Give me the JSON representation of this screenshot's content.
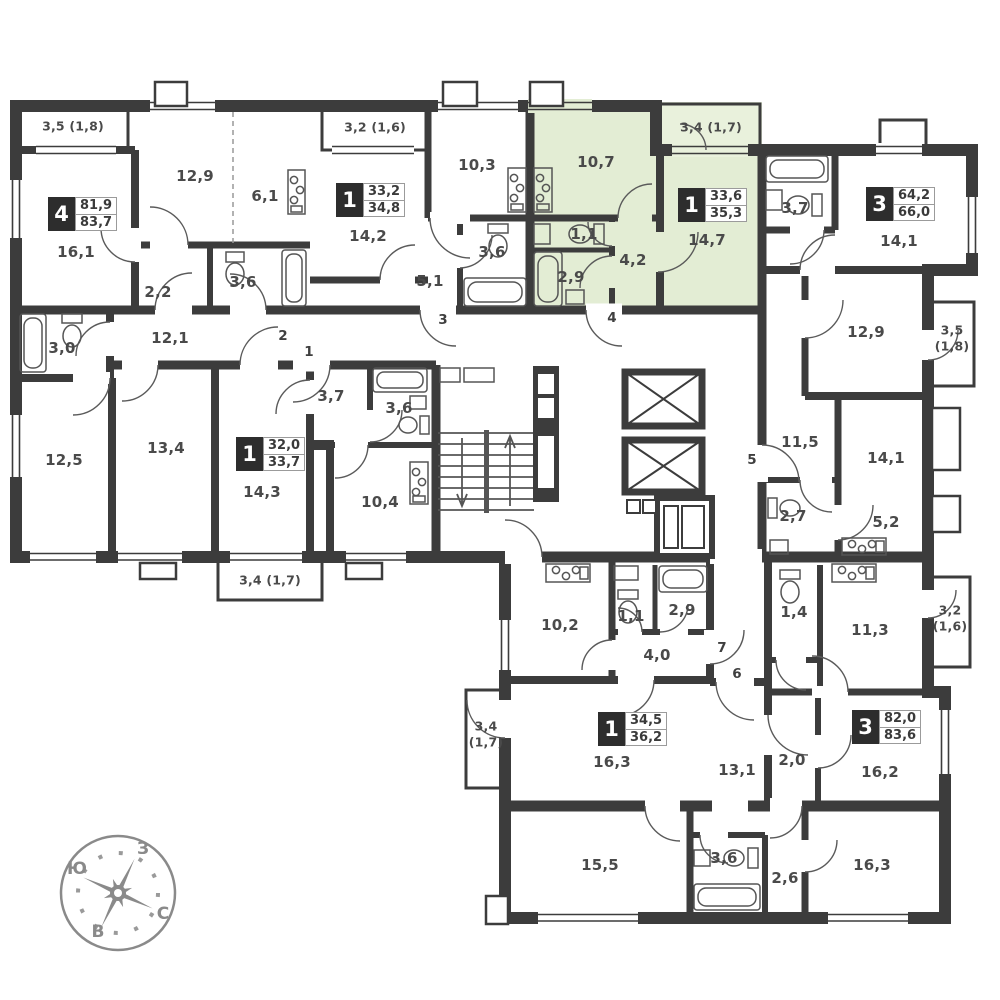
{
  "plan": {
    "colors": {
      "wall": "#3c3c3c",
      "text": "#4a4a4a",
      "highlight": "#e3edd4",
      "compass": "#8a8a8a",
      "background": "#ffffff"
    },
    "apartments": [
      {
        "id": "apartment-4-rooms-left",
        "badge": {
          "rooms": "4",
          "value_top": "81,9",
          "value_bottom": "83,7",
          "x": 48,
          "y": 197
        },
        "room_labels": [
          {
            "t": "3,5 (1,8)",
            "x": 73,
            "y": 126,
            "small": true
          },
          {
            "t": "12,9",
            "x": 195,
            "y": 176
          },
          {
            "t": "6,1",
            "x": 265,
            "y": 196
          },
          {
            "t": "16,1",
            "x": 76,
            "y": 252
          },
          {
            "t": "2,2",
            "x": 158,
            "y": 292
          },
          {
            "t": "3,6",
            "x": 243,
            "y": 282
          },
          {
            "t": "3,0",
            "x": 62,
            "y": 348
          },
          {
            "t": "12,1",
            "x": 170,
            "y": 338
          },
          {
            "t": "12,5",
            "x": 64,
            "y": 460
          },
          {
            "t": "13,4",
            "x": 166,
            "y": 448
          }
        ]
      },
      {
        "id": "apartment-1-room-32",
        "badge": {
          "rooms": "1",
          "value_top": "32,0",
          "value_bottom": "33,7",
          "x": 236,
          "y": 437
        },
        "room_labels": [
          {
            "t": "14,3",
            "x": 262,
            "y": 492
          },
          {
            "t": "3,4 (1,7)",
            "x": 270,
            "y": 580,
            "small": true
          },
          {
            "t": "3,7",
            "x": 331,
            "y": 396
          },
          {
            "t": "3,6",
            "x": 399,
            "y": 408
          },
          {
            "t": "10,4",
            "x": 380,
            "y": 502
          }
        ]
      },
      {
        "id": "apartment-1-room-33",
        "badge": {
          "rooms": "1",
          "value_top": "33,2",
          "value_bottom": "34,8",
          "x": 336,
          "y": 183
        },
        "room_labels": [
          {
            "t": "3,2 (1,6)",
            "x": 375,
            "y": 127,
            "small": true
          },
          {
            "t": "14,2",
            "x": 368,
            "y": 236
          },
          {
            "t": "10,3",
            "x": 477,
            "y": 165
          },
          {
            "t": "5,1",
            "x": 430,
            "y": 281
          },
          {
            "t": "3,6",
            "x": 492,
            "y": 252
          }
        ]
      },
      {
        "id": "apartment-1-room-selected",
        "badge": {
          "rooms": "1",
          "value_top": "33,6",
          "value_bottom": "35,3",
          "x": 678,
          "y": 188
        },
        "room_labels": [
          {
            "t": "10,7",
            "x": 596,
            "y": 162
          },
          {
            "t": "1,1",
            "x": 584,
            "y": 234
          },
          {
            "t": "2,9",
            "x": 571,
            "y": 277
          },
          {
            "t": "4,2",
            "x": 633,
            "y": 260
          },
          {
            "t": "14,7",
            "x": 707,
            "y": 240
          },
          {
            "t": "3,4 (1,7)",
            "x": 711,
            "y": 127,
            "small": true
          }
        ]
      },
      {
        "id": "apartment-3-rooms-64",
        "badge": {
          "rooms": "3",
          "value_top": "64,2",
          "value_bottom": "66,0",
          "x": 866,
          "y": 187
        },
        "room_labels": [
          {
            "t": "3,7",
            "x": 795,
            "y": 208
          },
          {
            "t": "14,1",
            "x": 899,
            "y": 241
          },
          {
            "t": "12,9",
            "x": 866,
            "y": 332
          },
          {
            "t": "3,5",
            "x": 952,
            "y": 330,
            "small": true
          },
          {
            "t": "(1,8)",
            "x": 952,
            "y": 346,
            "small": true
          },
          {
            "t": "11,5",
            "x": 800,
            "y": 442
          },
          {
            "t": "2,7",
            "x": 793,
            "y": 516
          },
          {
            "t": "14,1",
            "x": 886,
            "y": 458
          },
          {
            "t": "5,2",
            "x": 886,
            "y": 522
          }
        ]
      },
      {
        "id": "apartment-1-room-34",
        "badge": {
          "rooms": "1",
          "value_top": "34,5",
          "value_bottom": "36,2",
          "x": 598,
          "y": 712
        },
        "room_labels": [
          {
            "t": "10,2",
            "x": 560,
            "y": 625
          },
          {
            "t": "1,1",
            "x": 631,
            "y": 616
          },
          {
            "t": "2,9",
            "x": 682,
            "y": 610
          },
          {
            "t": "4,0",
            "x": 657,
            "y": 655
          },
          {
            "t": "16,3",
            "x": 612,
            "y": 762
          },
          {
            "t": "3,4",
            "x": 486,
            "y": 726,
            "small": true
          },
          {
            "t": "(1,7)",
            "x": 486,
            "y": 742,
            "small": true
          }
        ]
      },
      {
        "id": "apartment-3-rooms-82",
        "badge": {
          "rooms": "3",
          "value_top": "82,0",
          "value_bottom": "83,6",
          "x": 852,
          "y": 710
        },
        "room_labels": [
          {
            "t": "1,4",
            "x": 794,
            "y": 612
          },
          {
            "t": "11,3",
            "x": 870,
            "y": 630
          },
          {
            "t": "3,2",
            "x": 950,
            "y": 610,
            "small": true
          },
          {
            "t": "(1,6)",
            "x": 950,
            "y": 626,
            "small": true
          },
          {
            "t": "2,0",
            "x": 792,
            "y": 760
          },
          {
            "t": "16,2",
            "x": 880,
            "y": 772
          },
          {
            "t": "13,1",
            "x": 737,
            "y": 770
          },
          {
            "t": "15,5",
            "x": 600,
            "y": 865
          },
          {
            "t": "3,6",
            "x": 724,
            "y": 858
          },
          {
            "t": "2,6",
            "x": 785,
            "y": 878
          },
          {
            "t": "16,3",
            "x": 872,
            "y": 865
          }
        ]
      }
    ],
    "door_numbers": [
      {
        "t": "1",
        "x": 309,
        "y": 352
      },
      {
        "t": "2",
        "x": 283,
        "y": 336
      },
      {
        "t": "3",
        "x": 443,
        "y": 320
      },
      {
        "t": "4",
        "x": 612,
        "y": 318
      },
      {
        "t": "5",
        "x": 752,
        "y": 460
      },
      {
        "t": "6",
        "x": 737,
        "y": 674
      },
      {
        "t": "7",
        "x": 722,
        "y": 648
      }
    ],
    "compass": {
      "labels": [
        {
          "t": "З",
          "x": 143,
          "y": 849
        },
        {
          "t": "Ю",
          "x": 77,
          "y": 869
        },
        {
          "t": "В",
          "x": 98,
          "y": 932
        },
        {
          "t": "С",
          "x": 163,
          "y": 914
        }
      ]
    }
  }
}
